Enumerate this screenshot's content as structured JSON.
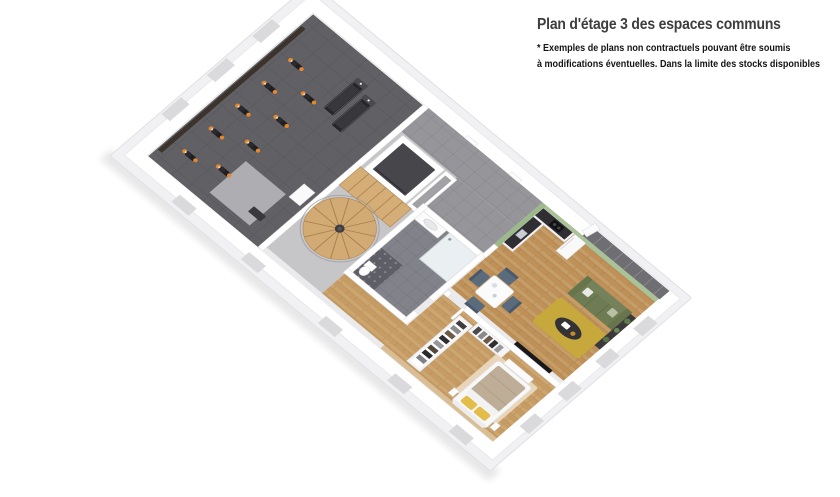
{
  "caption": {
    "title": "Plan d'étage 3 des espaces communs",
    "disclaimer_line1": "* Exemples de plans non contractuels pouvant être soumis",
    "disclaimer_line2": "à modifications éventuelles. Dans la limite des stocks disponibles",
    "title_color": "#3e3e3e",
    "disclaimer_color": "#141414"
  },
  "floor_plan": {
    "type": "3d-isometric-floor-plan",
    "areas": [
      "gym",
      "corridor",
      "elevator",
      "spiral-staircase",
      "bathroom",
      "kitchen",
      "dining-area",
      "living-room",
      "dressing",
      "bedroom"
    ],
    "palette": {
      "wall": "#ffffff",
      "slab": "#f1f1f3",
      "gym_floor": "#616165",
      "mirror_wall": "#3c342c",
      "hall_tile": "#96969a",
      "bath_tile": "#82828a",
      "wood": "#c69d66",
      "stair_wood": "#d2ab74",
      "sage_green": "#9cb98a",
      "sage_green_light": "#a9c297",
      "sofa_green": "#6d7c52",
      "rug_mustard": "#c7a83c",
      "pillow_yellow": "#e3bc4a",
      "bike_orange": "#e8872b",
      "equipment_dark": "#232326",
      "elevator_dark": "#46464b",
      "bedroom_accent": "#d9bd94",
      "bedroom_rug": "#ecdcc2",
      "window_glass": "#6f6f73",
      "counter_dark": "#2e2e33",
      "chair_slate": "#5a6b7c",
      "duvet_taupe": "#bfae97"
    }
  }
}
